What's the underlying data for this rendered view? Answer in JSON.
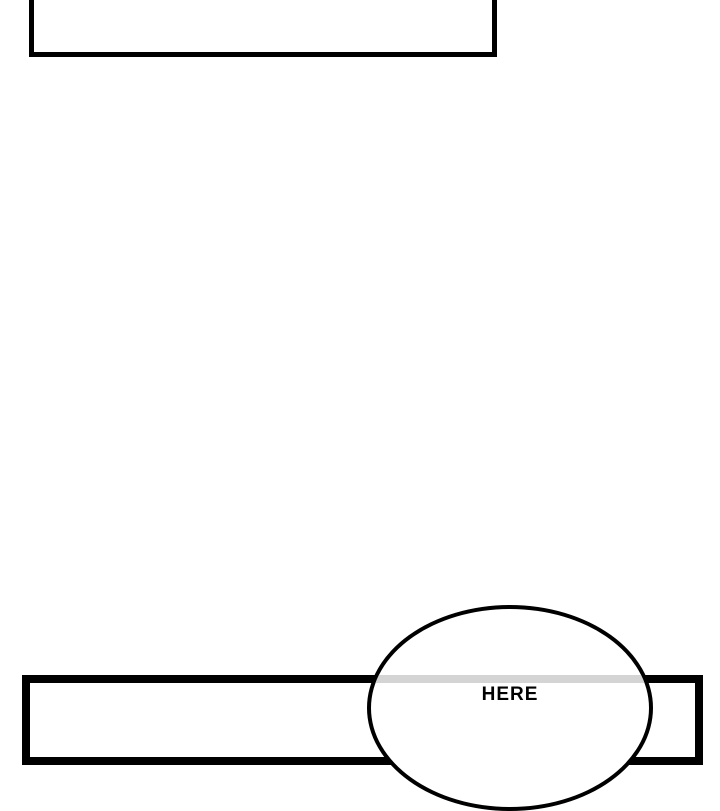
{
  "page": {
    "type": "webtoon-comic-strip-segment",
    "background": "#ffffff"
  },
  "colors": {
    "page_background": "#ffffff",
    "panel_border": "#000000",
    "bubble_border": "#000000",
    "bubble_fill": "#ffffff",
    "panel_border_through_bubble": "#d4d4d4"
  },
  "panels": {
    "top_panel": {
      "content": ""
    },
    "bottom_panel": {
      "content": ""
    }
  },
  "speech_bubble": {
    "text": "HERE"
  }
}
